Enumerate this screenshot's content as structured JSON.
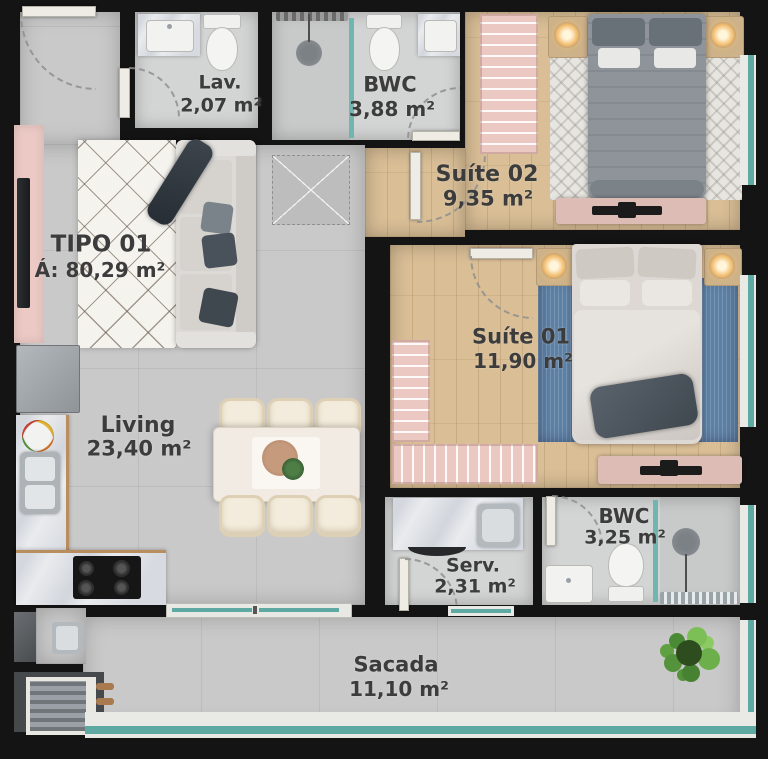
{
  "plan": {
    "title": {
      "name": "TIPO 01",
      "area": "Á: 80,29 m²"
    },
    "rooms": [
      {
        "id": "lav",
        "name": "Lav.",
        "area": "2,07 m²"
      },
      {
        "id": "bwc-top",
        "name": "BWC",
        "area": "3,88 m²"
      },
      {
        "id": "suite02",
        "name": "Suíte 02",
        "area": "9,35 m²"
      },
      {
        "id": "suite01",
        "name": "Suíte 01",
        "area": "11,90 m²"
      },
      {
        "id": "living",
        "name": "Living",
        "area": "23,40 m²"
      },
      {
        "id": "bwc-low",
        "name": "BWC",
        "area": "3,25 m²"
      },
      {
        "id": "serv",
        "name": "Serv.",
        "area": "2,31 m²"
      },
      {
        "id": "sacada",
        "name": "Sacada",
        "area": "11,10 m²"
      }
    ],
    "colors": {
      "wall": "#141414",
      "floor_tile": "#c9c9c9",
      "floor_wood": "#d9be96",
      "window_teal": "#5fa9a3",
      "wardrobe_pink": "#ecc8c2",
      "rug_blue": "#5d80a5",
      "label_text": "#3c3c3c"
    }
  }
}
